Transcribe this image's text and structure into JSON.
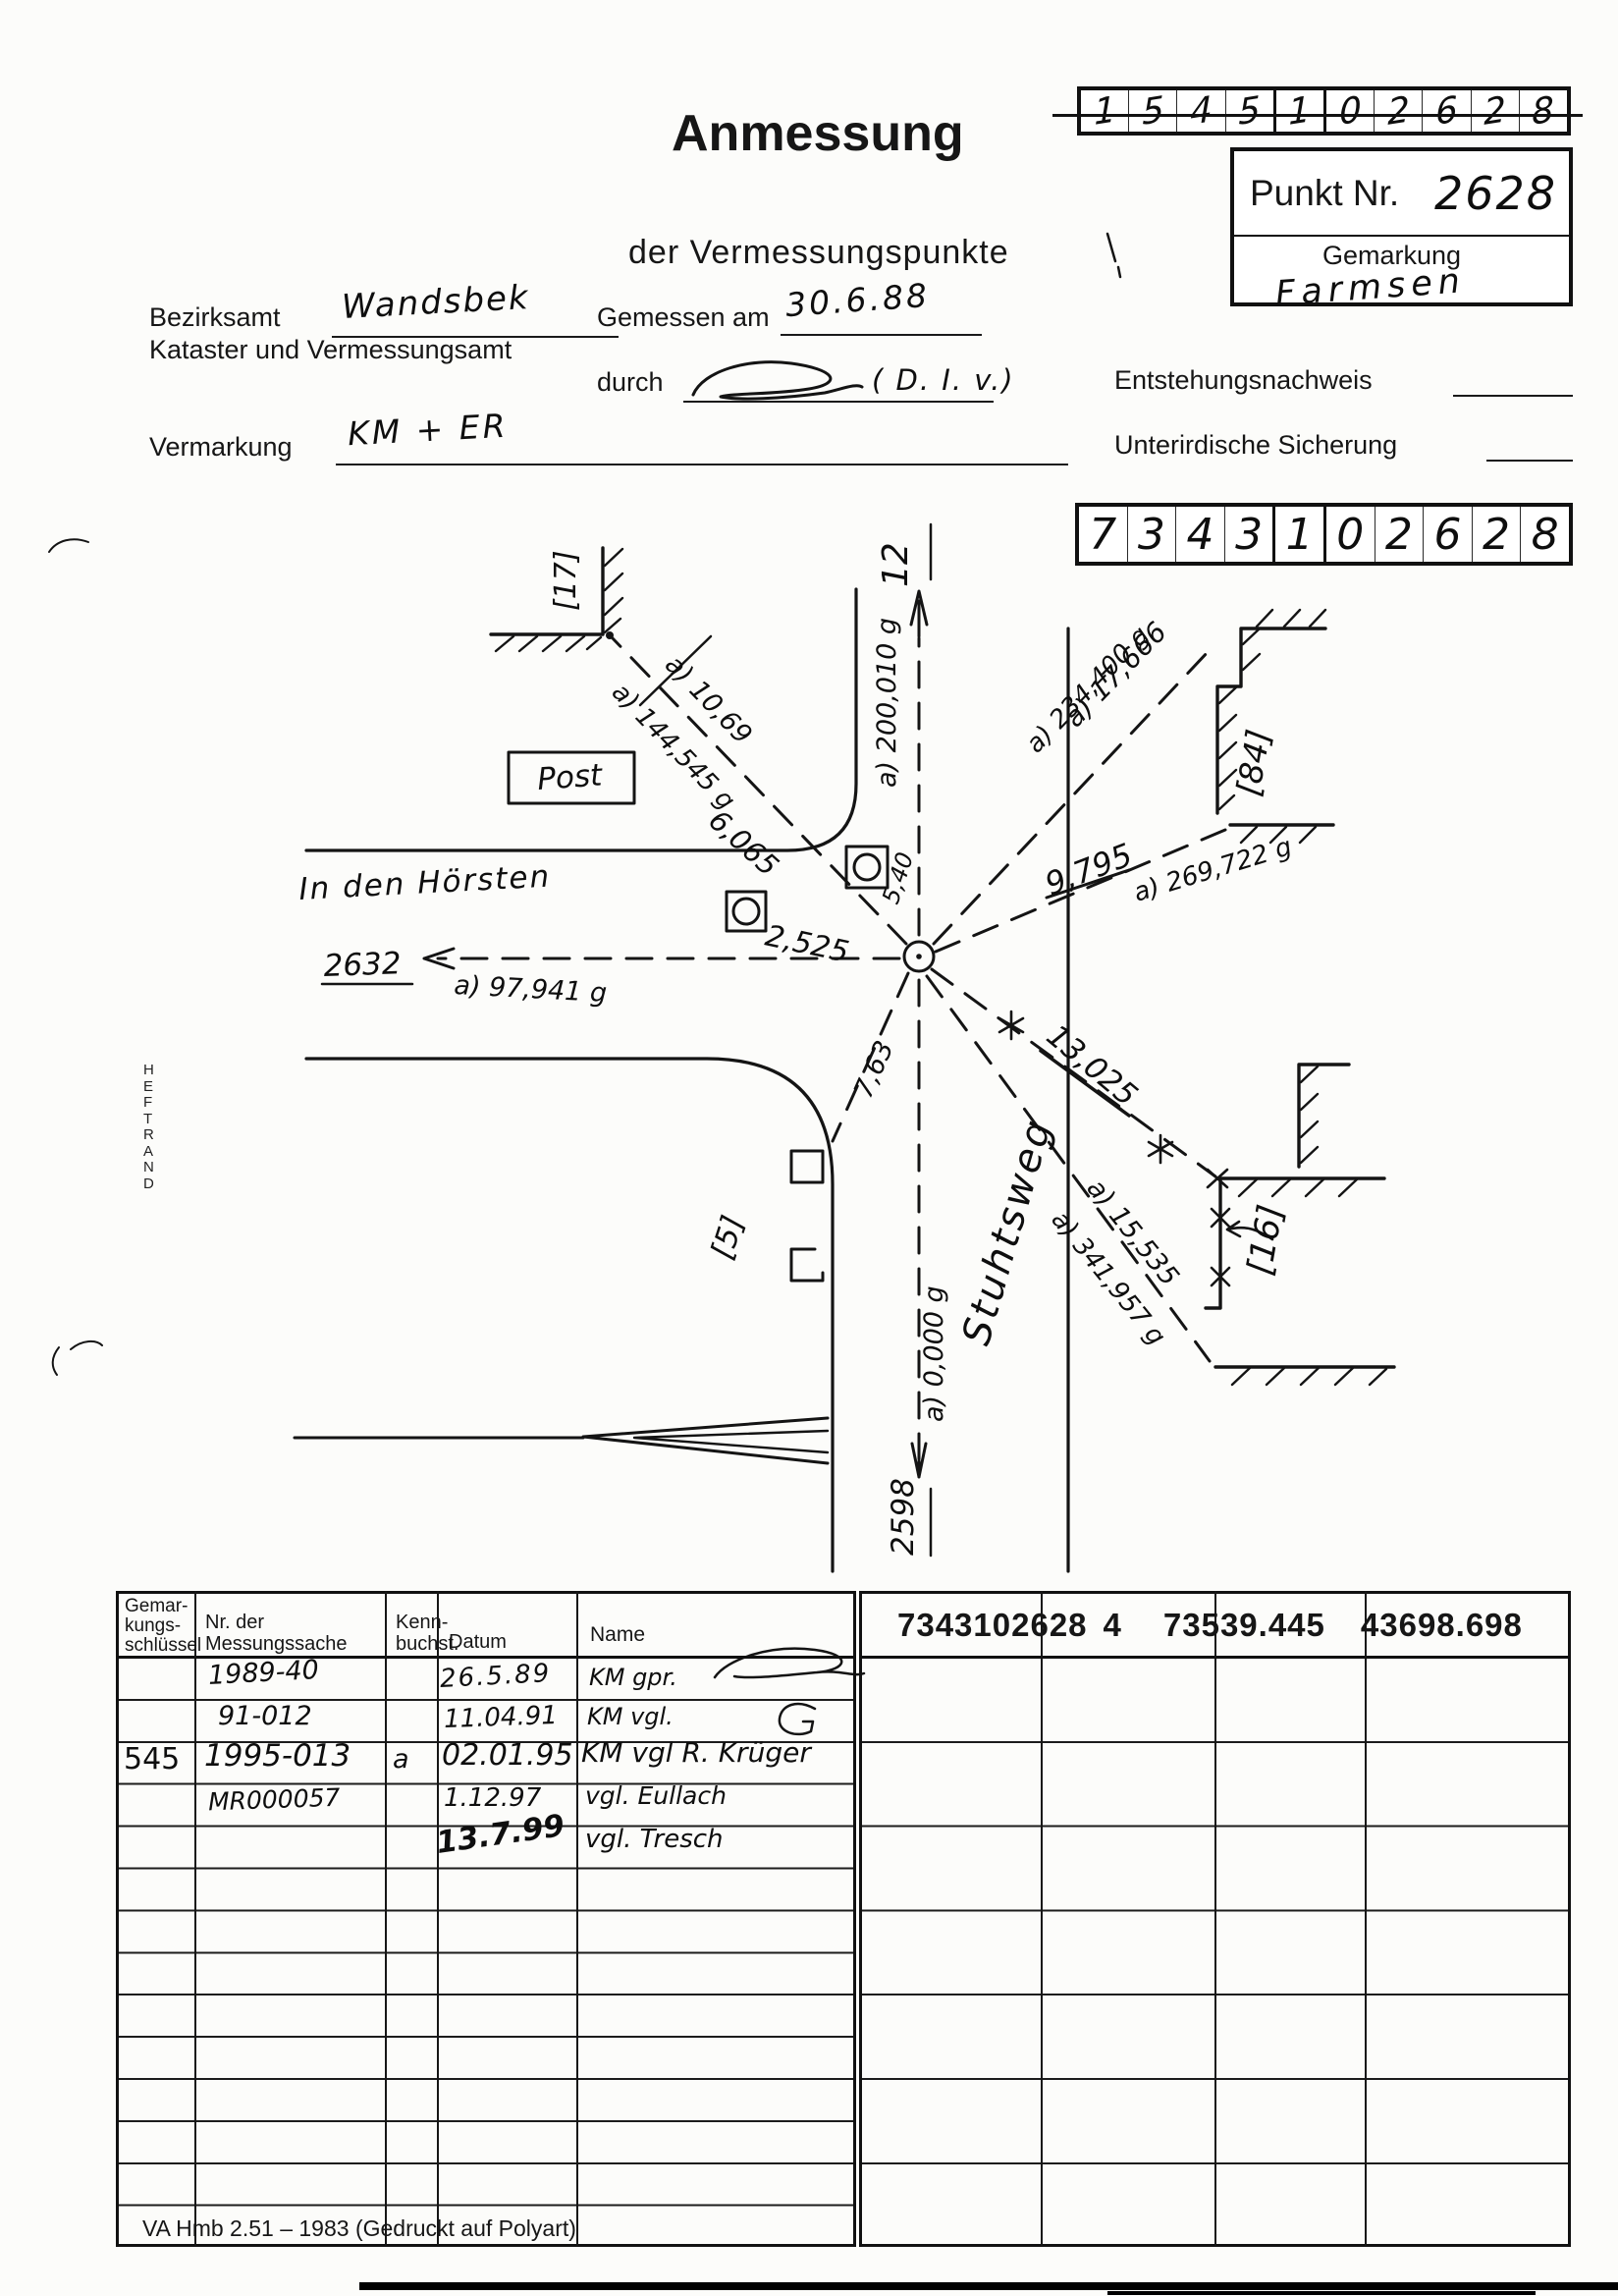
{
  "page": {
    "footer": "VA Hmb 2.51 – 1983 (Gedruckt auf Polyart)",
    "heftrand": "HEFTRAND"
  },
  "header": {
    "title": "Anmessung",
    "subtitle": "der Vermessungspunkte",
    "bezirksamt_label": "Bezirksamt",
    "bezirksamt_value": "Wandsbek",
    "kataster_label": "Kataster und Vermessungsamt",
    "gemessen_label": "Gemessen am",
    "gemessen_value": "30.6.88",
    "durch_label": "durch",
    "durch_value": "( D. I. v.)",
    "entstehung_label": "Entstehungsnachweis",
    "sicherung_label": "Unterirdische Sicherung",
    "vermarkung_label": "Vermarkung",
    "vermarkung_value": "KM + ER",
    "punkt_label": "Punkt Nr.",
    "punkt_value": "2628",
    "gemarkung_label": "Gemarkung",
    "gemarkung_value": "Farmsen",
    "code_top": [
      "1",
      "5",
      "4",
      "5",
      "1",
      "0",
      "2",
      "6",
      "2",
      "8"
    ],
    "code_bottom": [
      "7",
      "3",
      "4",
      "3",
      "1",
      "0",
      "2",
      "6",
      "2",
      "8"
    ]
  },
  "sketch": {
    "labels": {
      "street_no": "12",
      "bearing_n": "a) 200,010 g",
      "dist_nw": "a) 10,69",
      "bearing_nw": "a) 144,545 g",
      "post": "Post",
      "dist_post": "6,065",
      "dist_shaft": "2,525",
      "dist_small": "5,40",
      "street_w": "In den Hörsten",
      "point_w": "2632",
      "bearing_w": "a) 97,941 g",
      "dist_ne": "a) 17,666",
      "bearing_ne": "a) 234,400 g",
      "dist_e": "9,795",
      "bearing_e": "a) 269,722 g",
      "dist_se1": "13,025",
      "dist_se2": "a) 15,535",
      "bearing_se": "a) 341,957 g",
      "dist_sw": "7,63",
      "street_s": "Stuhtsweg",
      "bearing_s": "a) 0,000 g",
      "point_s": "2598",
      "bldg_nw": "[17]",
      "bldg_e": "[84]",
      "bldg_se": "[16]",
      "bldg_sw": "[5]"
    }
  },
  "table": {
    "col_gemarkung": "Gemar-\nkungs-\nschlüssel",
    "col_nr": "Nr. der\nMessungssache",
    "col_kenn": "Kenn-\nbuchst.",
    "col_datum": "Datum",
    "col_name": "Name",
    "rows": [
      {
        "key": "",
        "nr": "1989-40",
        "kenn": "",
        "datum": "26.5.89",
        "name": "KM gpr."
      },
      {
        "key": "",
        "nr": "91-012",
        "kenn": "",
        "datum": "11.04.91",
        "name": "KM vgl."
      },
      {
        "key": "545",
        "nr": "1995-013",
        "kenn": "a",
        "datum": "02.01.95",
        "name": "KM vgl  R. Krüger"
      },
      {
        "key": "",
        "nr": "MR000057",
        "kenn": "",
        "datum": "1.12.97",
        "name": "vgl. Eullach"
      },
      {
        "key": "",
        "nr": "",
        "kenn": "",
        "datum": "13.7.99",
        "name": "vgl. Tresch"
      }
    ],
    "coords": {
      "id": "7343102628",
      "suffix": "4",
      "easting": "73539.445",
      "northing": "43698.698"
    }
  }
}
